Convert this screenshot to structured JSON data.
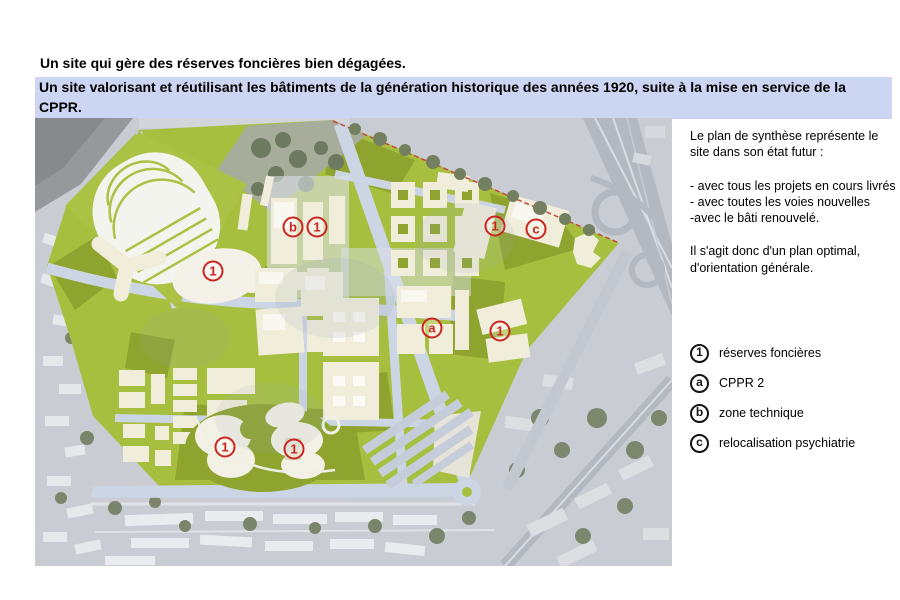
{
  "header": {
    "title": "Un site qui gère des réserves foncières bien dégagées.",
    "subtitle": "Un site valorisant et réutilisant les bâtiments de la génération historique des années 1920, suite à la mise en service de la CPPR."
  },
  "panel": {
    "intro": "Le plan de synthèse représente le site dans son état futur :",
    "bullets": [
      "- avec tous les projets en cours livrés",
      "- avec toutes les voies nouvelles",
      "-avec le bâti renouvelé."
    ],
    "conclusion": "Il s'agit donc d'un plan optimal, d'orientation générale."
  },
  "legend": {
    "items": [
      {
        "symbol": "1",
        "label": "réserves foncières"
      },
      {
        "symbol": "a",
        "label": "CPPR 2"
      },
      {
        "symbol": "b",
        "label": "zone technique"
      },
      {
        "symbol": "c",
        "label": "relocalisation psychiatrie"
      }
    ]
  },
  "map": {
    "description": "aerial masterplan of hospital site in future state",
    "markers": [
      {
        "symbol": "1",
        "x": 178,
        "y": 153
      },
      {
        "symbol": "b",
        "x": 258,
        "y": 109
      },
      {
        "symbol": "1",
        "x": 282,
        "y": 109
      },
      {
        "symbol": "1",
        "x": 460,
        "y": 108
      },
      {
        "symbol": "c",
        "x": 501,
        "y": 111
      },
      {
        "symbol": "a",
        "x": 397,
        "y": 210
      },
      {
        "symbol": "1",
        "x": 465,
        "y": 213
      },
      {
        "symbol": "1",
        "x": 190,
        "y": 329
      },
      {
        "symbol": "1",
        "x": 259,
        "y": 331
      }
    ]
  },
  "colors": {
    "highlight_band": "#ccd6f2",
    "marker_red": "#cc2420",
    "plan_green": "#a7bf3f",
    "plan_green_dark": "#8ea42e",
    "building_cream": "#f0edda",
    "road_blue_gray": "#ccd5e3",
    "aerial_gray": "#c9ccd2"
  }
}
